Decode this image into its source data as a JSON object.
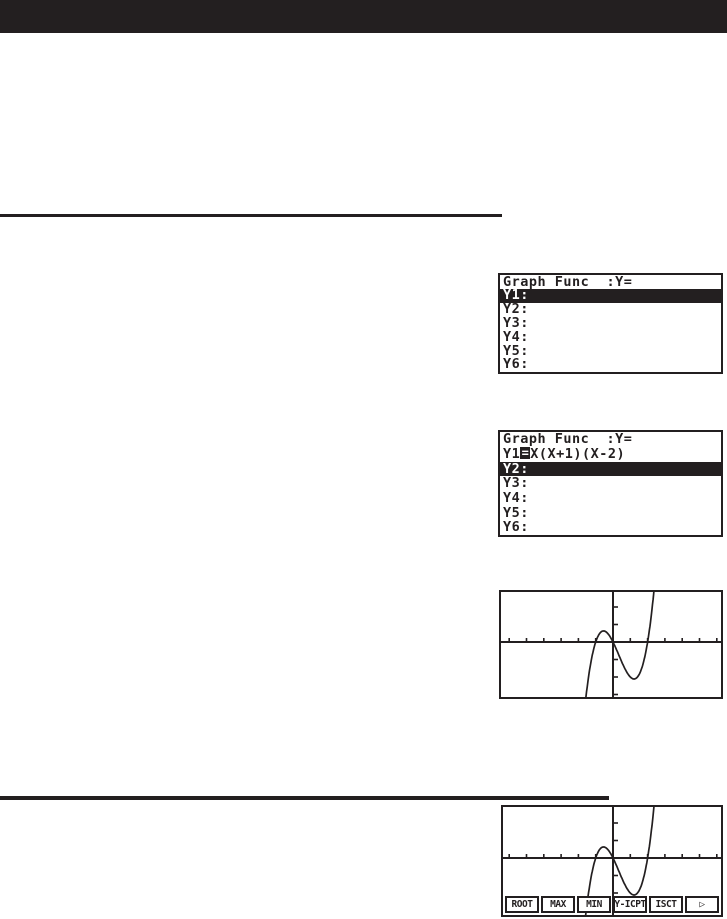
{
  "page": {
    "background": "#ffffff",
    "ink_color": "#231f20",
    "description_of_visible_content": "Manual page: black masthead bar, two black section rules, four calculator LCD screenshots"
  },
  "screens": [
    {
      "id": "func-list-empty",
      "header": "Graph Func  :Y=",
      "rows": [
        {
          "label": "Y1:",
          "selected": true
        },
        {
          "label": "Y2:"
        },
        {
          "label": "Y3:"
        },
        {
          "label": "Y4:"
        },
        {
          "label": "Y5:"
        },
        {
          "label": "Y6:"
        }
      ]
    },
    {
      "id": "func-list-y1-entered",
      "header": "Graph Func  :Y=",
      "rows": [
        {
          "label": "Y1",
          "eq_box": "=",
          "expr": "X(X+1)(X-2)"
        },
        {
          "label": "Y2:",
          "selected": true
        },
        {
          "label": "Y3:"
        },
        {
          "label": "Y4:"
        },
        {
          "label": "Y5:"
        },
        {
          "label": "Y6:"
        }
      ]
    },
    {
      "id": "graph-screen",
      "graph": {
        "origin_x": 112,
        "origin_y": 50,
        "px_per_unit_x": 17.3,
        "px_per_unit_y": 17.5,
        "x_tick_count": 6,
        "y_tick_count": 3
      }
    },
    {
      "id": "graph-gsolv-screen",
      "graph": {
        "origin_x": 110,
        "origin_y": 51,
        "px_per_unit_x": 17.3,
        "px_per_unit_y": 17.5,
        "x_tick_count": 6,
        "y_tick_count": 3
      },
      "menu": [
        "ROOT",
        "MAX",
        "MIN",
        "Y-ICPT",
        "ISCT",
        "▷"
      ]
    }
  ],
  "chart_data": {
    "type": "line",
    "title": "Graph of Y1 = X(X+1)(X-2)",
    "function": "y = x(x+1)(x-2)",
    "roots": [
      -1,
      0,
      2
    ],
    "local_max": {
      "x": -0.55,
      "y": 0.63
    },
    "local_min": {
      "x": 1.22,
      "y": -2.11
    },
    "x_range": [
      -6.3,
      6.3
    ],
    "y_range": [
      -3.1,
      3.1
    ],
    "tick_interval": 1,
    "grid": false,
    "legend": "none",
    "axes": "cross at origin with unit tick marks"
  }
}
